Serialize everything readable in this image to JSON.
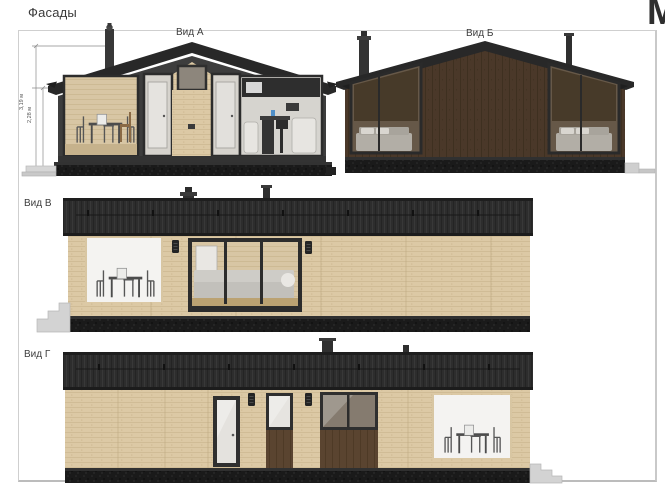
{
  "sheet": {
    "title": "Фасады",
    "corner_mark": "M"
  },
  "views": {
    "a": {
      "label": "Вид А",
      "dim_ridge": "3,19 м",
      "dim_wall": "2,28 м"
    },
    "b": {
      "label": "Вид Б"
    },
    "v": {
      "label": "Вид В"
    },
    "g": {
      "label": "Вид Г"
    }
  },
  "colors": {
    "roof": "#2b2b2b",
    "siding_light": "#dcc8a3",
    "siding_dark": "#4a3829",
    "panel_brown": "#5a4430",
    "glass_tint": "#665848",
    "plinth": "#1a1a1a",
    "frame_line": "#cfcfcf"
  }
}
